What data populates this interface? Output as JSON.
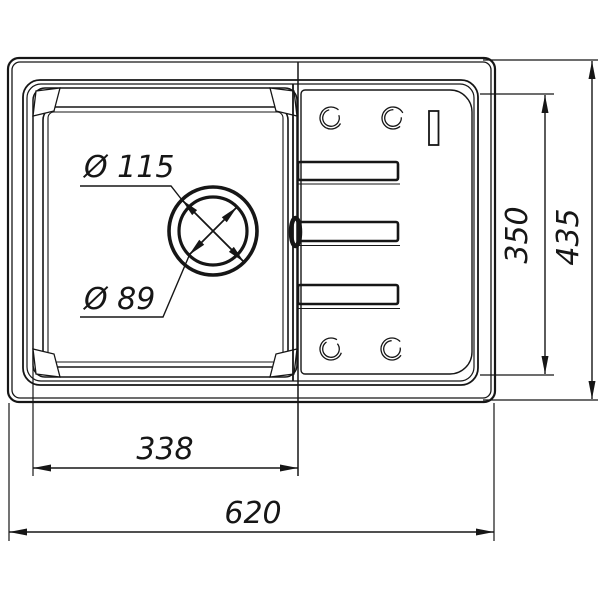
{
  "drawing": {
    "subject": "kitchen-sink-top-view-technical-drawing",
    "background_color": "#ffffff",
    "line_color": "#161616",
    "labels": {
      "overall_width": "620",
      "overall_height": "435",
      "bowl_width": "338",
      "inner_height": "350",
      "drain_outer_diameter": "Ø 115",
      "drain_inner_diameter": "Ø 89"
    }
  }
}
